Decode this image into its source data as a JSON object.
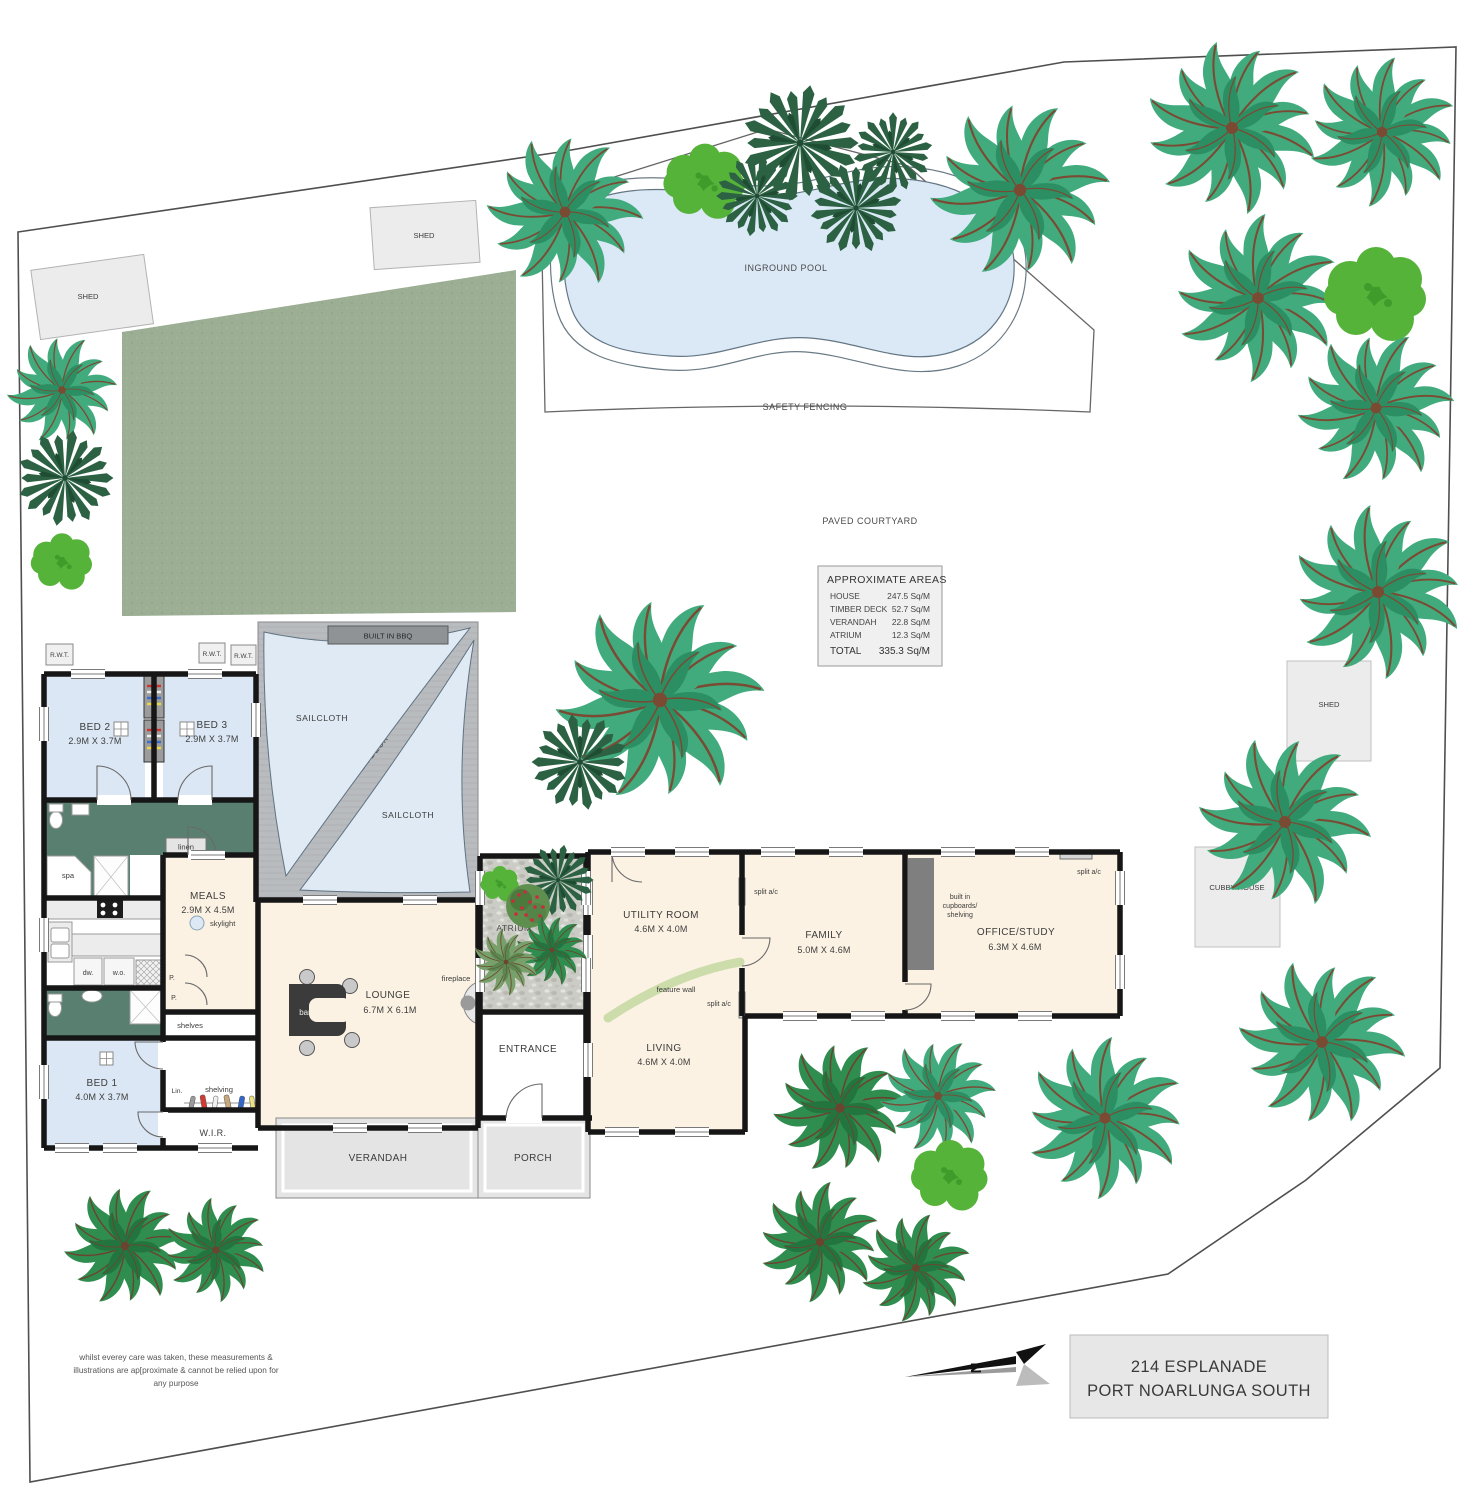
{
  "footer": {
    "address_line1": "214 ESPLANADE",
    "address_line2": "PORT NOARLUNGA SOUTH",
    "disclaimer1": "whilst everey care was taken, these measurements &",
    "disclaimer2": "illustrations are ap[proximate & cannot be relied upon for",
    "disclaimer3": "any purpose",
    "north_label": "N"
  },
  "areas": {
    "title": "APPROXIMATE AREAS",
    "rows": [
      {
        "label": "HOUSE",
        "value": "247.5 Sq/M"
      },
      {
        "label": "TIMBER DECK",
        "value": "52.7 Sq/M"
      },
      {
        "label": "VERANDAH",
        "value": "22.8 Sq/M"
      },
      {
        "label": "ATRIUM",
        "value": "12.3 Sq/M"
      }
    ],
    "total_label": "TOTAL",
    "total_value": "335.3 Sq/M"
  },
  "site": {
    "shed": "SHED",
    "cubby_house": "CUBBY HOUSE",
    "inground_pool": "INGROUND POOL",
    "safety_fencing": "SAFETY FENCING",
    "paved_courtyard": "PAVED COURTYARD",
    "rwt": "R.W.T."
  },
  "outdoor": {
    "sailcloth": "SAILCLOTH",
    "timber_deck": "TIMBER DECK",
    "built_in_bbq": "BUILT IN BBQ",
    "verandah": "VERANDAH",
    "porch": "PORCH",
    "atrium": "ATRIUM"
  },
  "rooms": {
    "bed1": {
      "name": "BED 1",
      "dims": "4.0M X 3.7M"
    },
    "bed2": {
      "name": "BED 2",
      "dims": "2.9M X 3.7M"
    },
    "bed3": {
      "name": "BED 3",
      "dims": "2.9M X 3.7M"
    },
    "meals": {
      "name": "MEALS",
      "dims": "2.9M X 4.5M"
    },
    "lounge": {
      "name": "LOUNGE",
      "dims": "6.7M X 6.1M"
    },
    "utility": {
      "name": "UTILITY ROOM",
      "dims": "4.6M X 4.0M"
    },
    "living": {
      "name": "LIVING",
      "dims": "4.6M X 4.0M"
    },
    "family": {
      "name": "FAMILY",
      "dims": "5.0M X 4.6M"
    },
    "office": {
      "name": "OFFICE/STUDY",
      "dims": "6.3M X 4.6M"
    },
    "entrance": {
      "name": "ENTRANCE"
    },
    "wir": {
      "name": "W.I.R."
    }
  },
  "fixtures": {
    "bar": "bar",
    "fireplace": "fireplace",
    "skylight": "skylight",
    "linen": "linen",
    "spa": "spa",
    "dw": "dw.",
    "wo": "w.o.",
    "p": "P.",
    "shelves": "shelves",
    "lin": "Lin.",
    "shelving": "shelving",
    "feature_wall": "feature wall",
    "split_ac": "split a/c",
    "built_in_1": "built in",
    "built_in_2": "cupboards/",
    "built_in_3": "shelving"
  },
  "palette": {
    "palm": {
      "sym": "t-palm",
      "c1": "#41ab7e",
      "c2": "#2c8f63",
      "rib": "#7b4a33"
    },
    "palm2": {
      "sym": "t-palm",
      "c1": "#5cb83e",
      "c2": "#47a52e",
      "rib": "#8a6a3c"
    },
    "palm3": {
      "sym": "t-palm",
      "c1": "#2f8d4f",
      "c2": "#23753f",
      "rib": "#6b4430"
    },
    "fan": {
      "sym": "t-fan",
      "c1": "#2c6243",
      "c2": "#1f4d33",
      "rib": "#1f4d33"
    },
    "shrub": {
      "sym": "t-shrub",
      "c1": "#55b339",
      "c2": "#3f9c2a",
      "rib": "#3f9c2a"
    }
  },
  "colors": {
    "wall": "#161616",
    "bedroom": "#dbe7f4",
    "bathroom": "#587f6f",
    "living_cream": "#fbf2e3",
    "deck": "#b7babd",
    "sail": "#e0eaf4",
    "lawn": "#9cae93",
    "pool": "#dbe9f7"
  },
  "trees": [
    {
      "t": "palm",
      "x": 565,
      "y": 212,
      "s": 1.35,
      "r": 10
    },
    {
      "t": "shrub",
      "x": 705,
      "y": 182,
      "s": 1.6
    },
    {
      "t": "fan",
      "x": 800,
      "y": 143,
      "s": 1.15
    },
    {
      "t": "fan",
      "x": 757,
      "y": 196,
      "s": 0.8,
      "r": 40
    },
    {
      "t": "fan",
      "x": 856,
      "y": 208,
      "s": 0.9,
      "r": -30
    },
    {
      "t": "fan",
      "x": 893,
      "y": 152,
      "s": 0.78,
      "r": 70
    },
    {
      "t": "palm",
      "x": 1020,
      "y": 190,
      "s": 1.55
    },
    {
      "t": "palm",
      "x": 1232,
      "y": 128,
      "s": 1.5,
      "r": 25
    },
    {
      "t": "palm",
      "x": 1382,
      "y": 132,
      "s": 1.3,
      "r": -15
    },
    {
      "t": "palm",
      "x": 1258,
      "y": 298,
      "s": 1.45,
      "r": 40
    },
    {
      "t": "shrub",
      "x": 1376,
      "y": 295,
      "s": 2.0
    },
    {
      "t": "palm",
      "x": 1376,
      "y": 408,
      "s": 1.35,
      "r": 60
    },
    {
      "t": "palm",
      "x": 1378,
      "y": 592,
      "s": 1.5,
      "r": -30
    },
    {
      "t": "palm",
      "x": 1285,
      "y": 822,
      "s": 1.5,
      "r": 15
    },
    {
      "t": "palm",
      "x": 1322,
      "y": 1042,
      "s": 1.45,
      "r": -45
    },
    {
      "t": "palm",
      "x": 660,
      "y": 700,
      "s": 1.8
    },
    {
      "t": "fan",
      "x": 580,
      "y": 762,
      "s": 0.95,
      "r": 20
    },
    {
      "t": "palm",
      "x": 62,
      "y": 390,
      "s": 0.95
    },
    {
      "t": "fan",
      "x": 65,
      "y": 478,
      "s": 0.95
    },
    {
      "t": "shrub",
      "x": 62,
      "y": 562,
      "s": 1.2
    },
    {
      "t": "palm3",
      "x": 125,
      "y": 1246,
      "s": 1.05
    },
    {
      "t": "palm3",
      "x": 216,
      "y": 1250,
      "s": 0.9,
      "r": 30
    },
    {
      "t": "palm3",
      "x": 840,
      "y": 1108,
      "s": 1.15
    },
    {
      "t": "palm",
      "x": 938,
      "y": 1096,
      "s": 1.0,
      "r": 60
    },
    {
      "t": "shrub",
      "x": 950,
      "y": 1176,
      "s": 1.5
    },
    {
      "t": "palm",
      "x": 1105,
      "y": 1118,
      "s": 1.4,
      "r": -20
    },
    {
      "t": "palm3",
      "x": 820,
      "y": 1242,
      "s": 1.05,
      "r": 45
    },
    {
      "t": "palm3",
      "x": 916,
      "y": 1268,
      "s": 0.95,
      "r": -10
    }
  ]
}
